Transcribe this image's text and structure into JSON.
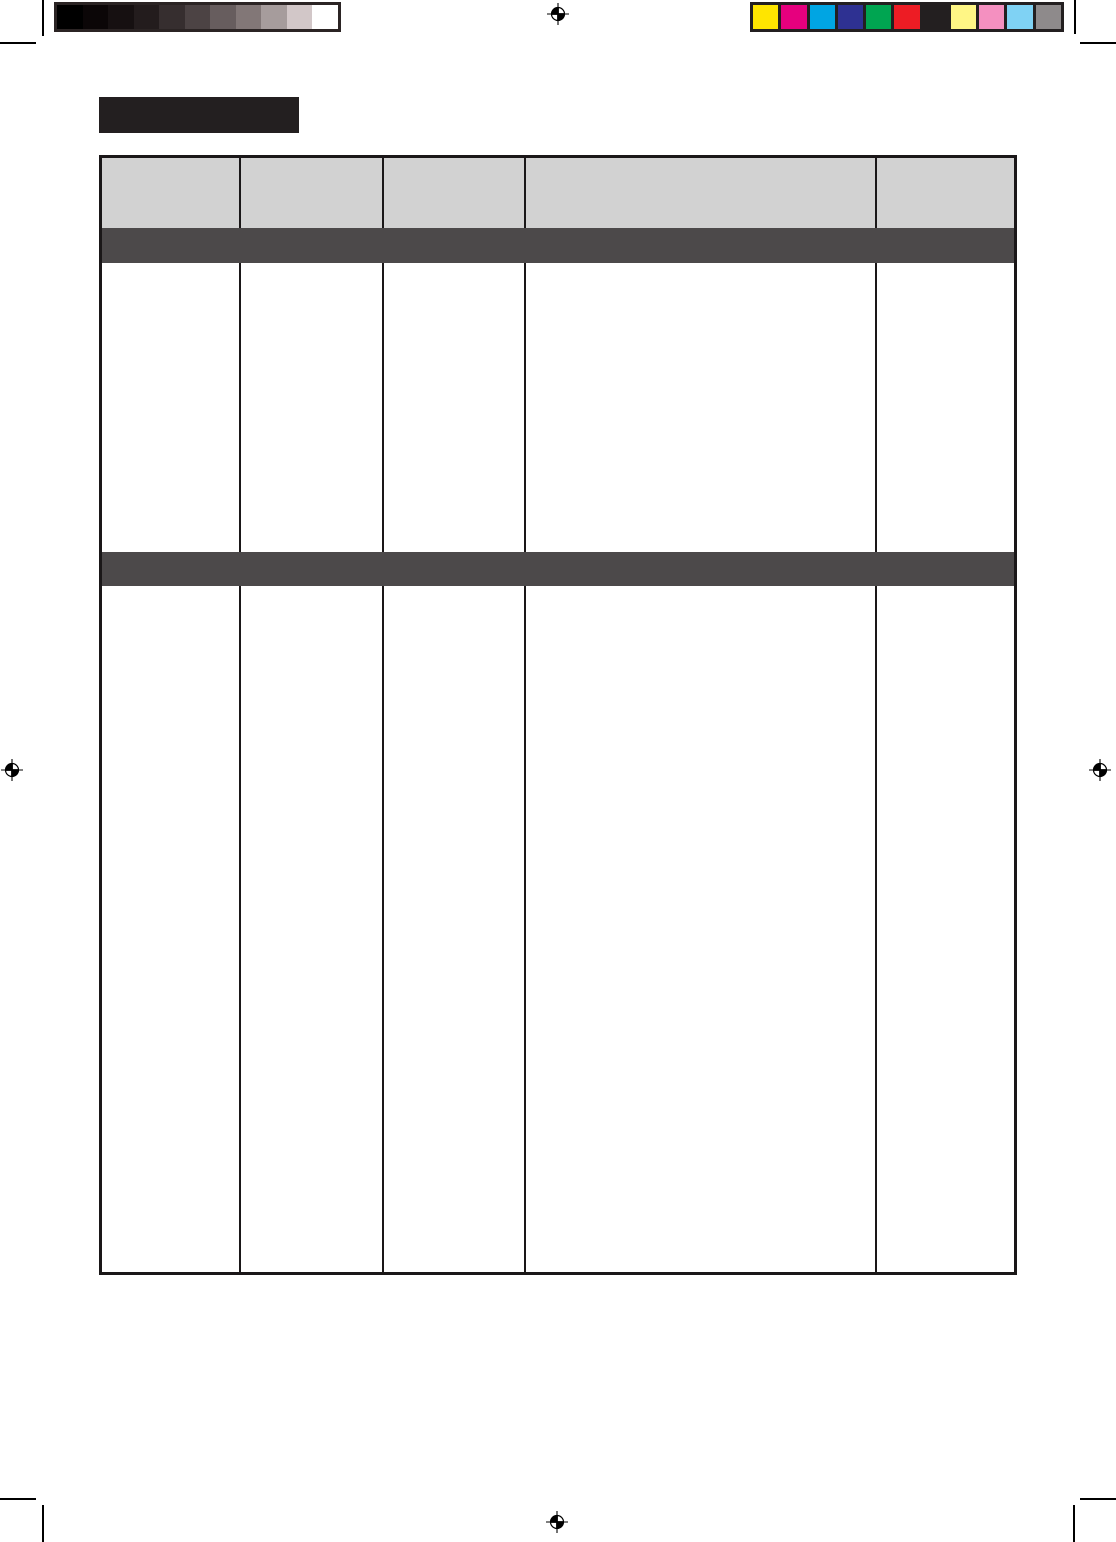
{
  "page": {
    "background": "#ffffff",
    "crop_mark_color": "#000000",
    "registration_mark_color": "#000000"
  },
  "calibration": {
    "grayscale_bar": {
      "border_color": "#2b2424",
      "swatches": [
        "#000000",
        "#0b0607",
        "#161011",
        "#231c1d",
        "#362e2f",
        "#4c4344",
        "#675d5e",
        "#827777",
        "#a69c9c",
        "#d2c7c8",
        "#ffffff"
      ]
    },
    "color_bar": {
      "background": "#231f20",
      "swatches": [
        "#ffe500",
        "#e6007e",
        "#00a5e3",
        "#2e3192",
        "#00a551",
        "#ed1c24",
        "#231f20",
        "#fff685",
        "#f490c0",
        "#7fd2f4",
        "#8e8a8b"
      ]
    }
  },
  "title_block": {
    "label": "",
    "background": "#231f20"
  },
  "table": {
    "border_color": "#1a1718",
    "header": {
      "background": "#d2d2d2",
      "labels": [
        "",
        "",
        "",
        "",
        ""
      ]
    },
    "section_bars": [
      {
        "label": "",
        "background": "#4c494a"
      },
      {
        "label": "",
        "background": "#4c494a"
      }
    ],
    "bands": [
      {
        "cells": [
          "",
          "",
          "",
          "",
          ""
        ]
      },
      {
        "cells": [
          "",
          "",
          "",
          "",
          ""
        ]
      }
    ]
  }
}
